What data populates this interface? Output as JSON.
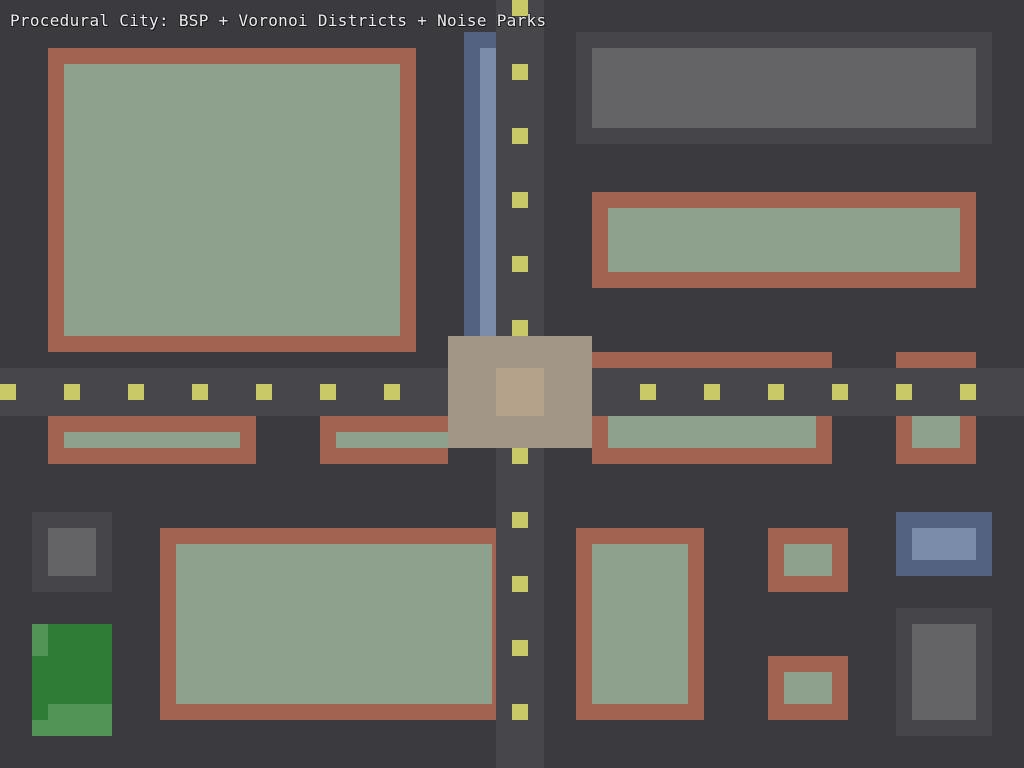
{
  "title": {
    "text": "Procedural City: BSP + Voronoi Districts + Noise Parks"
  },
  "canvas": {
    "width": 1024,
    "height": 768
  },
  "palette": {
    "background": "#3a3a3f",
    "road": "#47474b",
    "dash": "#c9c965",
    "wall": "#a26351",
    "roof": "#8da18c",
    "plaza": "#a29786",
    "plaza_core": "#b5a28b",
    "water": "#51617f",
    "water_light": "#7b8cab",
    "block": "#46464a",
    "block_light": "#646467",
    "park": "#2f7c37",
    "park_light": "#519455",
    "title_color": "#ededed"
  },
  "map": {
    "roads": [
      {
        "name": "road-vertical",
        "x": 496,
        "y": 0,
        "w": 48,
        "h": 768,
        "color": "road"
      },
      {
        "name": "road-horizontal",
        "x": 0,
        "y": 368,
        "w": 1024,
        "h": 48,
        "color": "road"
      }
    ],
    "lane_dashes": {
      "size": 16,
      "vertical": {
        "x": 512,
        "ys": [
          0,
          64,
          128,
          192,
          256,
          320,
          448,
          512,
          576,
          640,
          704
        ]
      },
      "horizontal": {
        "y": 384,
        "xs": [
          0,
          64,
          128,
          192,
          256,
          320,
          384,
          640,
          704,
          768,
          832,
          896,
          960
        ]
      }
    },
    "river": [
      {
        "name": "river-channel",
        "x": 464,
        "y": 32,
        "w": 32,
        "h": 304,
        "color": "water"
      },
      {
        "name": "river-highlight",
        "x": 480,
        "y": 48,
        "w": 16,
        "h": 288,
        "color": "water_light"
      }
    ],
    "plaza": [
      {
        "name": "plaza-square",
        "x": 448,
        "y": 336,
        "w": 144,
        "h": 112,
        "color": "plaza"
      },
      {
        "name": "plaza-core",
        "x": 496,
        "y": 368,
        "w": 48,
        "h": 48,
        "color": "plaza_core"
      }
    ],
    "buildings": [
      {
        "name": "residential-block-nw",
        "parts": [
          {
            "part": "wall",
            "x": 48,
            "y": 48,
            "w": 368,
            "h": 304,
            "color": "wall"
          },
          {
            "part": "roof",
            "x": 64,
            "y": 64,
            "w": 336,
            "h": 272,
            "color": "roof"
          }
        ]
      },
      {
        "name": "industrial-block-ne",
        "parts": [
          {
            "part": "base",
            "x": 576,
            "y": 32,
            "w": 416,
            "h": 112,
            "color": "block"
          },
          {
            "part": "top",
            "x": 592,
            "y": 48,
            "w": 384,
            "h": 80,
            "color": "block_light"
          }
        ]
      },
      {
        "name": "residential-block-ne",
        "parts": [
          {
            "part": "wall",
            "x": 592,
            "y": 192,
            "w": 384,
            "h": 96,
            "color": "wall"
          },
          {
            "part": "roof",
            "x": 608,
            "y": 208,
            "w": 352,
            "h": 64,
            "color": "roof"
          }
        ]
      },
      {
        "name": "roadside-strip-east-1",
        "parts": [
          {
            "part": "wall",
            "x": 592,
            "y": 352,
            "w": 240,
            "h": 16,
            "color": "wall"
          }
        ]
      },
      {
        "name": "roadside-strip-east-2",
        "parts": [
          {
            "part": "wall",
            "x": 896,
            "y": 352,
            "w": 80,
            "h": 16,
            "color": "wall"
          }
        ]
      },
      {
        "name": "roadside-block-west-1",
        "parts": [
          {
            "part": "wall",
            "x": 48,
            "y": 416,
            "w": 208,
            "h": 48,
            "color": "wall"
          },
          {
            "part": "roof",
            "x": 64,
            "y": 432,
            "w": 176,
            "h": 16,
            "color": "roof"
          }
        ]
      },
      {
        "name": "roadside-block-west-2",
        "parts": [
          {
            "part": "wall",
            "x": 320,
            "y": 416,
            "w": 128,
            "h": 48,
            "color": "wall"
          },
          {
            "part": "roof",
            "x": 336,
            "y": 432,
            "w": 112,
            "h": 16,
            "color": "roof"
          }
        ]
      },
      {
        "name": "roadside-block-east-1",
        "parts": [
          {
            "part": "wall",
            "x": 592,
            "y": 416,
            "w": 240,
            "h": 48,
            "color": "wall"
          },
          {
            "part": "roof",
            "x": 608,
            "y": 416,
            "w": 208,
            "h": 32,
            "color": "roof"
          }
        ]
      },
      {
        "name": "roadside-block-east-2",
        "parts": [
          {
            "part": "wall",
            "x": 896,
            "y": 416,
            "w": 80,
            "h": 48,
            "color": "wall"
          },
          {
            "part": "roof",
            "x": 912,
            "y": 416,
            "w": 48,
            "h": 32,
            "color": "roof"
          }
        ]
      },
      {
        "name": "industrial-block-sw",
        "parts": [
          {
            "part": "base",
            "x": 32,
            "y": 512,
            "w": 80,
            "h": 80,
            "color": "block"
          },
          {
            "part": "top",
            "x": 48,
            "y": 528,
            "w": 48,
            "h": 48,
            "color": "block_light"
          }
        ]
      },
      {
        "name": "park-sw",
        "parts": [
          {
            "part": "lawn",
            "x": 32,
            "y": 624,
            "w": 80,
            "h": 112,
            "color": "park"
          },
          {
            "part": "meadow-1",
            "x": 32,
            "y": 624,
            "w": 16,
            "h": 32,
            "color": "park_light"
          },
          {
            "part": "meadow-2",
            "x": 48,
            "y": 704,
            "w": 64,
            "h": 16,
            "color": "park_light"
          },
          {
            "part": "meadow-3",
            "x": 32,
            "y": 720,
            "w": 80,
            "h": 16,
            "color": "park_light"
          }
        ]
      },
      {
        "name": "residential-block-s",
        "parts": [
          {
            "part": "wall",
            "x": 160,
            "y": 528,
            "w": 336,
            "h": 192,
            "color": "wall"
          },
          {
            "part": "roof",
            "x": 176,
            "y": 544,
            "w": 316,
            "h": 160,
            "color": "roof"
          }
        ]
      },
      {
        "name": "residential-block-se-1",
        "parts": [
          {
            "part": "wall",
            "x": 576,
            "y": 528,
            "w": 128,
            "h": 192,
            "color": "wall"
          },
          {
            "part": "roof",
            "x": 592,
            "y": 544,
            "w": 96,
            "h": 160,
            "color": "roof"
          }
        ]
      },
      {
        "name": "residential-block-se-2",
        "parts": [
          {
            "part": "wall",
            "x": 768,
            "y": 528,
            "w": 80,
            "h": 64,
            "color": "wall"
          },
          {
            "part": "roof",
            "x": 784,
            "y": 544,
            "w": 48,
            "h": 32,
            "color": "roof"
          }
        ]
      },
      {
        "name": "residential-block-se-3",
        "parts": [
          {
            "part": "wall",
            "x": 768,
            "y": 656,
            "w": 80,
            "h": 64,
            "color": "wall"
          },
          {
            "part": "roof",
            "x": 784,
            "y": 672,
            "w": 48,
            "h": 32,
            "color": "roof"
          }
        ]
      },
      {
        "name": "waterfront-block-se",
        "parts": [
          {
            "part": "base",
            "x": 896,
            "y": 512,
            "w": 96,
            "h": 64,
            "color": "water"
          },
          {
            "part": "top",
            "x": 912,
            "y": 528,
            "w": 64,
            "h": 32,
            "color": "water_light"
          }
        ]
      },
      {
        "name": "industrial-block-se",
        "parts": [
          {
            "part": "base",
            "x": 896,
            "y": 608,
            "w": 96,
            "h": 128,
            "color": "block"
          },
          {
            "part": "top",
            "x": 912,
            "y": 624,
            "w": 64,
            "h": 96,
            "color": "block_light"
          }
        ]
      }
    ]
  }
}
